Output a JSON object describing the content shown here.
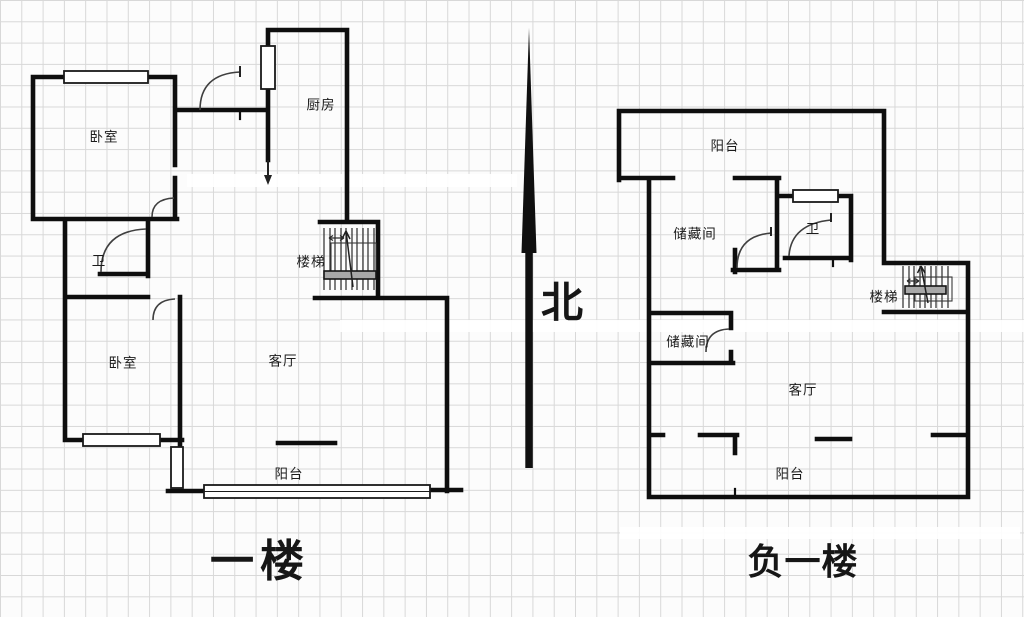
{
  "compass": {
    "label": "北"
  },
  "floor1": {
    "title": "一楼",
    "rooms": {
      "bedroom1": "卧室",
      "kitchen": "厨房",
      "bathroom": "卫",
      "stairs": "楼梯",
      "bedroom2": "卧室",
      "living_room": "客厅",
      "balcony": "阳台"
    }
  },
  "basement": {
    "title": "负一楼",
    "rooms": {
      "balcony_top": "阳台",
      "storage1": "储藏间",
      "bathroom": "卫",
      "stairs": "楼梯",
      "storage2": "储藏间",
      "living_room": "客厅",
      "balcony_bottom": "阳台"
    }
  },
  "colors": {
    "wall": "#0e0e0e",
    "grid": "#d8d8d8",
    "paper": "#fcfcfc",
    "tread": "#a8a8a8",
    "text": "#1b1b1b",
    "arc": "#3f3f3f"
  }
}
